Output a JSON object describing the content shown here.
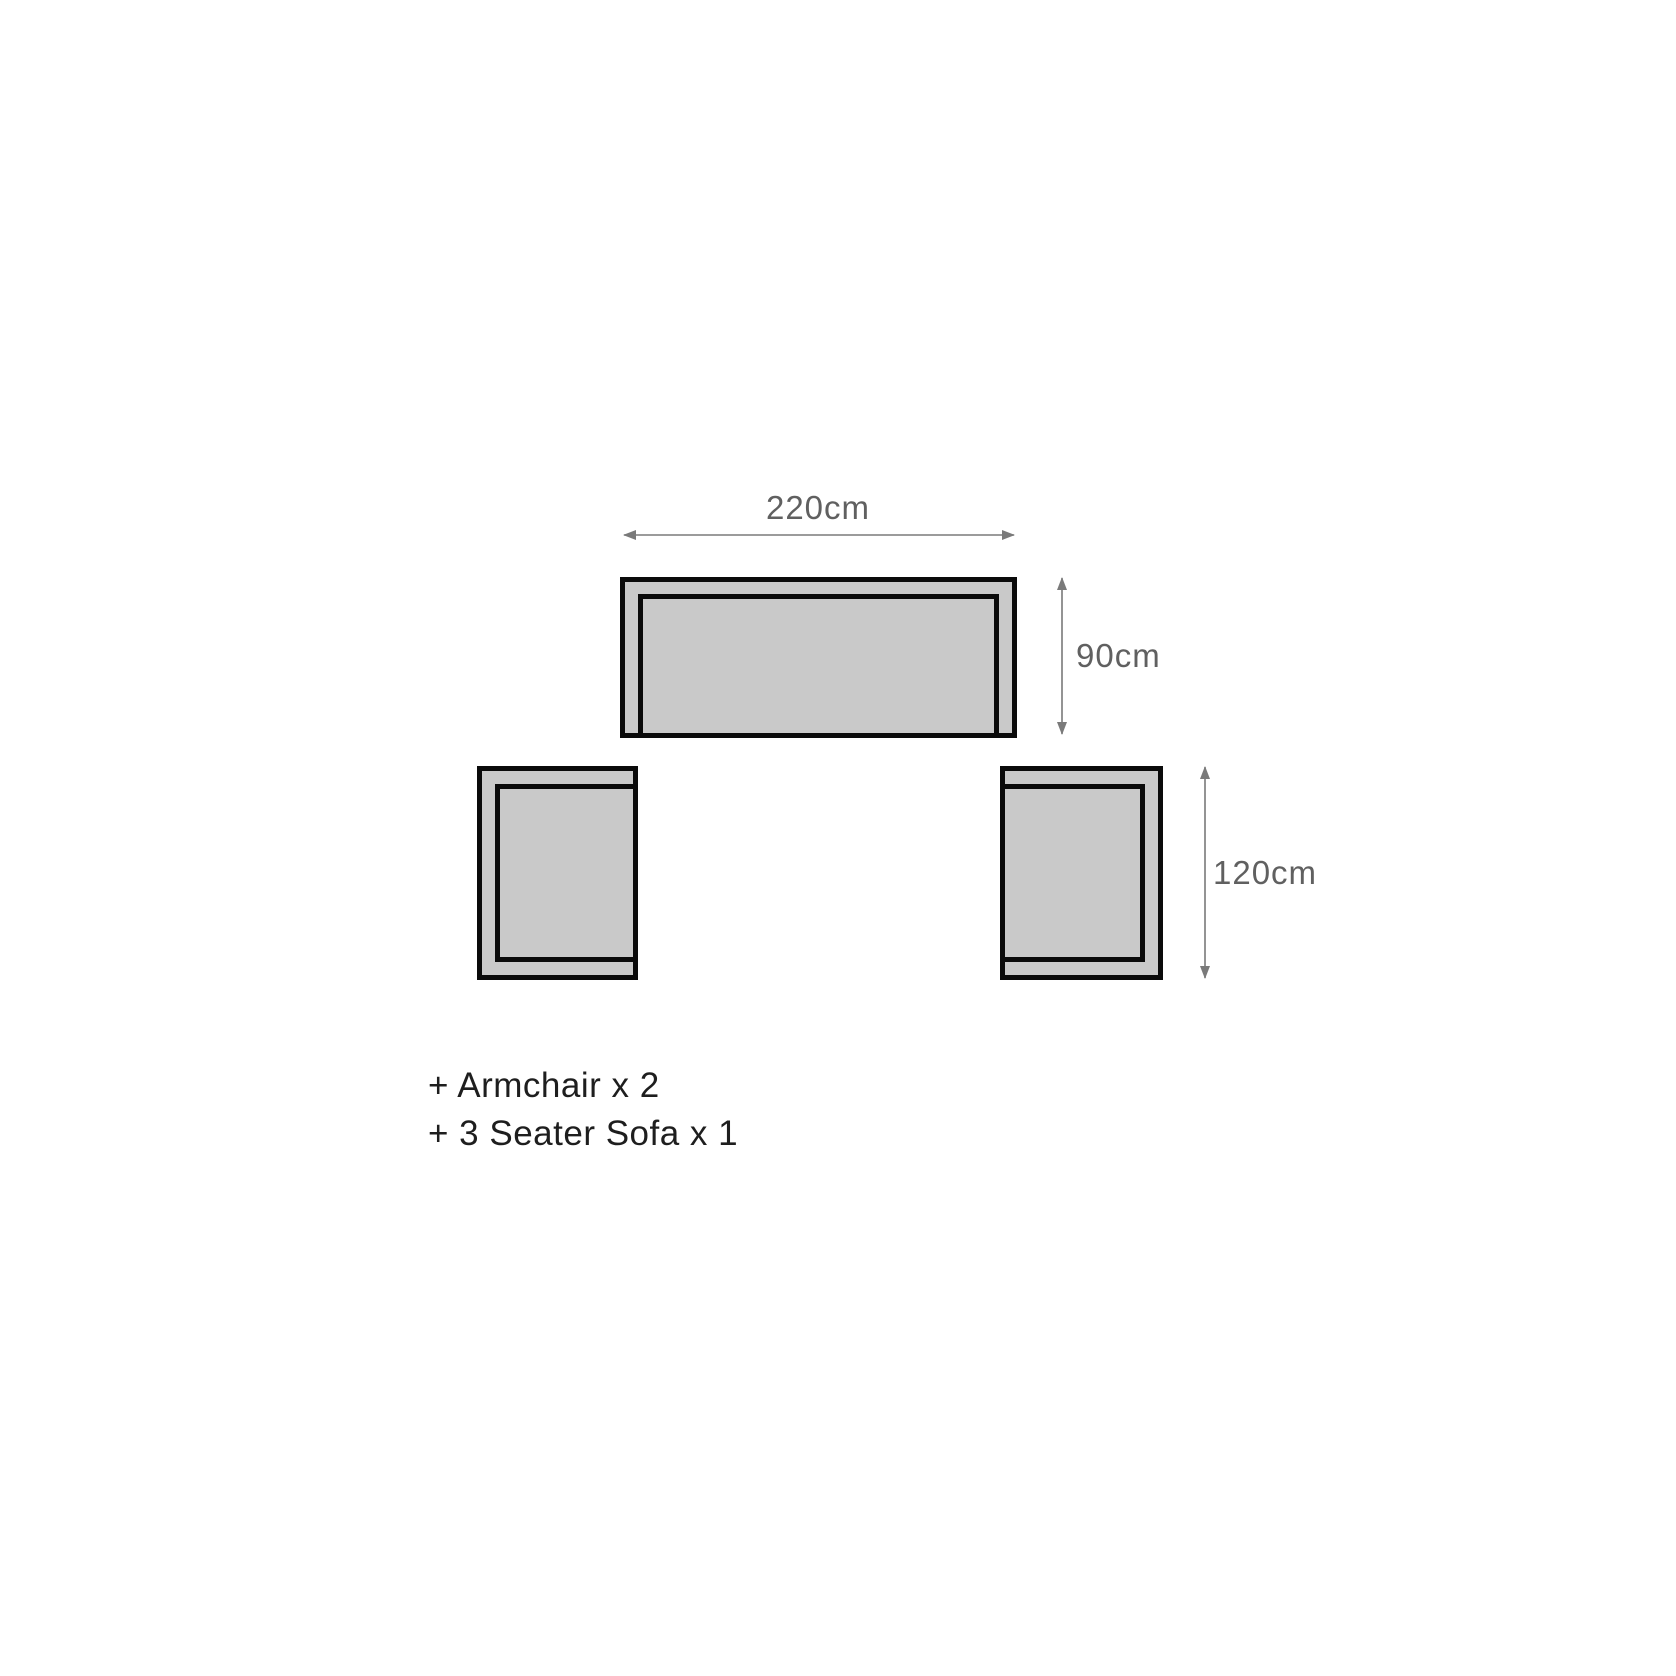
{
  "diagram": {
    "type": "furniture-dimension-top-view",
    "pieces": [
      {
        "name": "3-seater-sofa",
        "width_cm": 220,
        "depth_cm": 90
      },
      {
        "name": "armchair-left",
        "depth_cm": 120
      },
      {
        "name": "armchair-right",
        "depth_cm": 120
      }
    ],
    "dimensions": {
      "sofa_width": "220cm",
      "sofa_depth": "90cm",
      "armchair_depth": "120cm"
    },
    "legend": {
      "armchair": "+ Armchair x 2",
      "sofa": "+ 3 Seater Sofa x 1"
    },
    "colors": {
      "background": "#ffffff",
      "furniture_fill": "#c9c9c9",
      "furniture_outline": "#0a0a0a",
      "dimension_text": "#606060",
      "arrow": "#7a7a7a",
      "legend_text": "#1e1e1e"
    }
  }
}
